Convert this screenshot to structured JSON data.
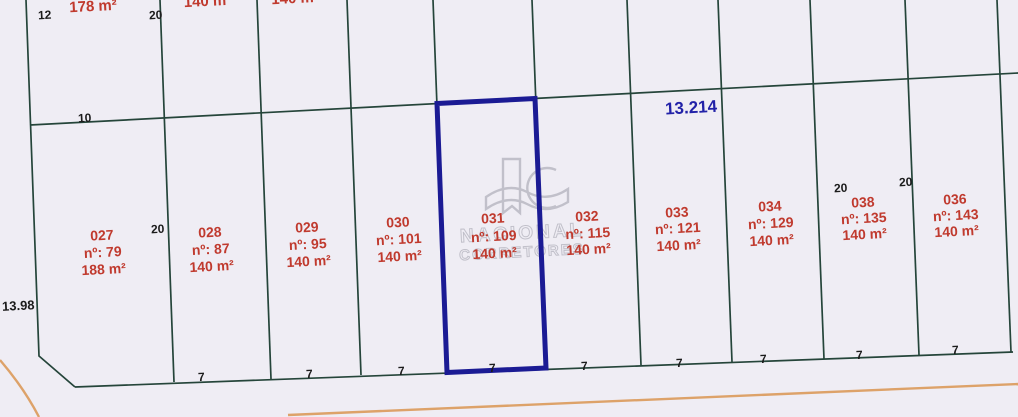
{
  "title": "Loteamento - planta de lotes",
  "colors": {
    "background": "#efedf4",
    "boundary": "#25453a",
    "highlight": "#1b1b94",
    "dimension_text": "#1b1b1b",
    "lot_text": "#c03a2e",
    "total_text": "#2222a8",
    "road": "#dda269",
    "watermark": "#9d9da8"
  },
  "dims": {
    "top_left_width": "12",
    "top_width_a": "20",
    "depth_top": "10",
    "mid_width": "20",
    "left_depth": "13.98",
    "width_038_a": "20",
    "width_038_b": "20",
    "frontage": "7",
    "total_width": "13.214"
  },
  "top_partials": {
    "area1": "178 m²",
    "area2": "140 m",
    "area3": "140 m²"
  },
  "lots": [
    {
      "id": "027",
      "num": "nº: 79",
      "area": "188 m²"
    },
    {
      "id": "028",
      "num": "nº: 87",
      "area": "140 m²"
    },
    {
      "id": "029",
      "num": "nº: 95",
      "area": "140 m²"
    },
    {
      "id": "030",
      "num": "nº: 101",
      "area": "140 m²"
    },
    {
      "id": "031",
      "num": "nº: 109",
      "area": "140 m²",
      "highlighted": true
    },
    {
      "id": "032",
      "num": "nº: 115",
      "area": "140 m²"
    },
    {
      "id": "033",
      "num": "nº: 121",
      "area": "140 m²"
    },
    {
      "id": "034",
      "num": "nº: 129",
      "area": "140 m²"
    },
    {
      "id": "038",
      "num": "nº: 135",
      "area": "140 m²"
    },
    {
      "id": "036",
      "num": "nº: 143",
      "area": "140 m²"
    }
  ],
  "watermark": {
    "line1": "NACIONAL",
    "line2": "CORRETORES"
  }
}
